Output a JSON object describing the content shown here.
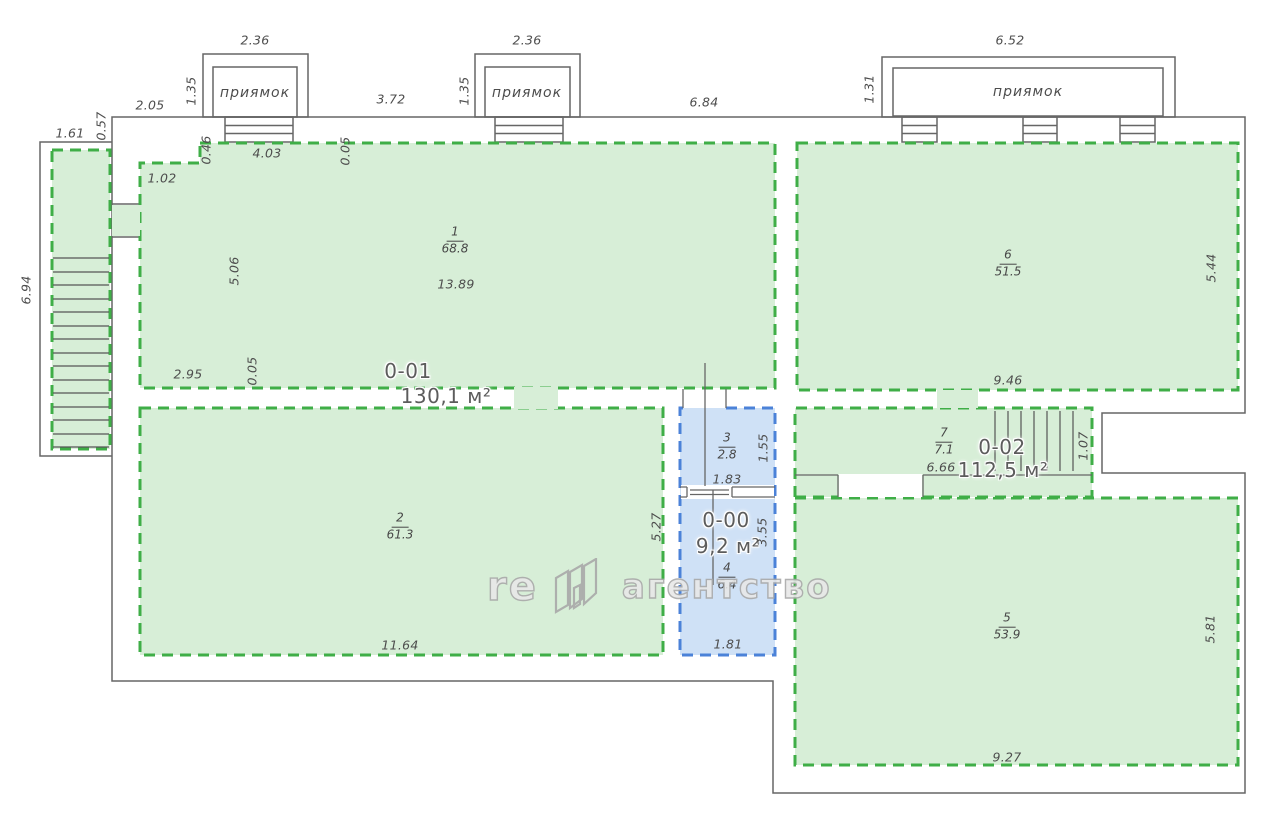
{
  "units": {
    "u01": {
      "code": "0-01",
      "area": "130,1 м²"
    },
    "u00": {
      "code": "0-00",
      "area": "9,2 м²"
    },
    "u02": {
      "code": "0-02",
      "area": "112,5 м²"
    }
  },
  "rooms": {
    "r1": {
      "num": "1",
      "area": "68.8"
    },
    "r2": {
      "num": "2",
      "area": "61.3"
    },
    "r3": {
      "num": "3",
      "area": "2.8"
    },
    "r4": {
      "num": "4",
      "area": "6.4"
    },
    "r5": {
      "num": "5",
      "area": "53.9"
    },
    "r6": {
      "num": "6",
      "area": "51.5"
    },
    "r7": {
      "num": "7",
      "area": "7.1"
    }
  },
  "pits": {
    "p1": {
      "label": "приямок",
      "width": "2.36",
      "depth": "1.35"
    },
    "p2": {
      "label": "приямок",
      "width": "2.36",
      "depth": "1.35"
    },
    "p3": {
      "label": "приямок",
      "width": "6.52",
      "depth": "1.31"
    }
  },
  "dims": {
    "gap_left": "2.05",
    "gap_mid": "3.72",
    "gap_right": "6.84",
    "stair_w": "1.61",
    "stair_off": "0.57",
    "stair_len": "6.94",
    "step_w": "1.02",
    "step_h": "0.46",
    "r1_top": "4.03",
    "r1_top_jog": "0.05",
    "r1_left": "5.06",
    "r1_width": "13.89",
    "r1_bottom_left": "2.95",
    "r1_bottom_jog": "0.05",
    "r2_bottom": "11.64",
    "r2_right": "5.27",
    "r3_right": "1.55",
    "r3_bottom": "1.83",
    "r4_right": "3.55",
    "r4_bottom": "1.81",
    "r6_right": "5.44",
    "r6_bottom": "9.46",
    "r7_len": "6.66",
    "stairs2_w": "1.07",
    "r5_right": "5.81",
    "r5_bottom": "9.27"
  },
  "watermark": {
    "prefix": "re",
    "suffix": "агентство"
  },
  "colors": {
    "room_green_fill": "#d7eed7",
    "room_green_border": "#3fae47",
    "room_blue_fill": "#cfe1f6",
    "room_blue_border": "#4b82d8",
    "wall": "#666666",
    "dim_text": "#4d4d4d"
  }
}
